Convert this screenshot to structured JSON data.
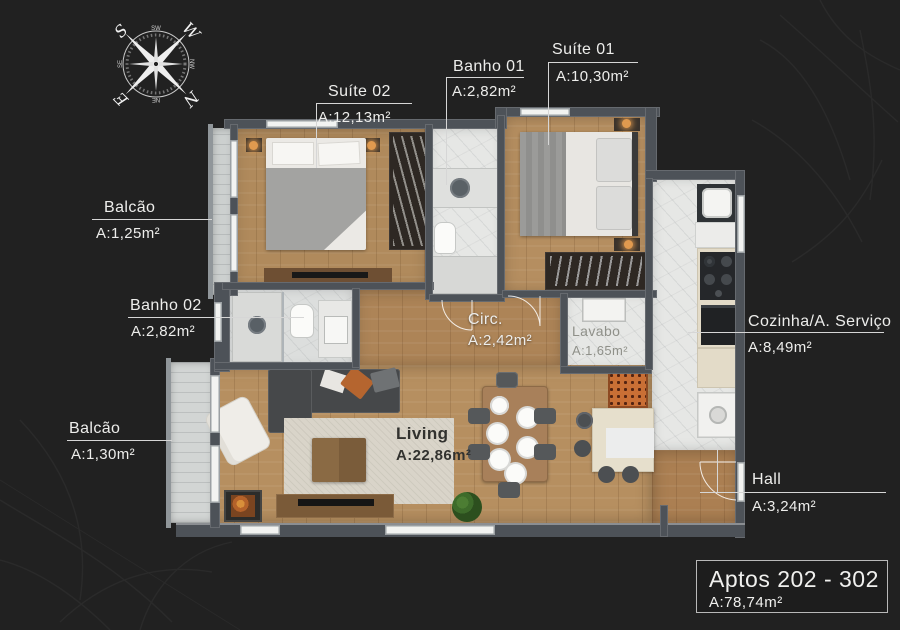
{
  "title_box": {
    "title": "Aptos 202 - 302",
    "area": "A:78,74m²"
  },
  "compass": {
    "outer": [
      "S",
      "W",
      "E",
      "N"
    ],
    "inner": [
      "SW",
      "NW",
      "NE",
      "SE"
    ]
  },
  "rooms": [
    {
      "id": "suite-02",
      "label": "Suíte 02",
      "area": "A:12,13m²"
    },
    {
      "id": "banho-01",
      "label": "Banho 01",
      "area": "A:2,82m²"
    },
    {
      "id": "suite-01",
      "label": "Suíte 01",
      "area": "A:10,30m²"
    },
    {
      "id": "balcao-01",
      "label": "Balcão",
      "area": "A:1,25m²"
    },
    {
      "id": "banho-02",
      "label": "Banho 02",
      "area": "A:2,82m²"
    },
    {
      "id": "circ",
      "label": "Circ.",
      "area": "A:2,42m²"
    },
    {
      "id": "lavabo",
      "label": "Lavabo",
      "area": "A:1,65m²"
    },
    {
      "id": "cozinha",
      "label": "Cozinha/A. Serviço",
      "area": "A:8,49m²"
    },
    {
      "id": "balcao-02",
      "label": "Balcão",
      "area": "A:1,30m²"
    },
    {
      "id": "living",
      "label": "Living",
      "area": "A:22,86m²"
    },
    {
      "id": "hall",
      "label": "Hall",
      "area": "A:3,24m²"
    }
  ],
  "colors": {
    "background": "#212121",
    "wood_floor": "#b08a5c",
    "marble_floor": "#e6e7e5",
    "wall": "#4d5258",
    "label_text": "#ededeb",
    "lamp_glow": "#e09a4f"
  }
}
